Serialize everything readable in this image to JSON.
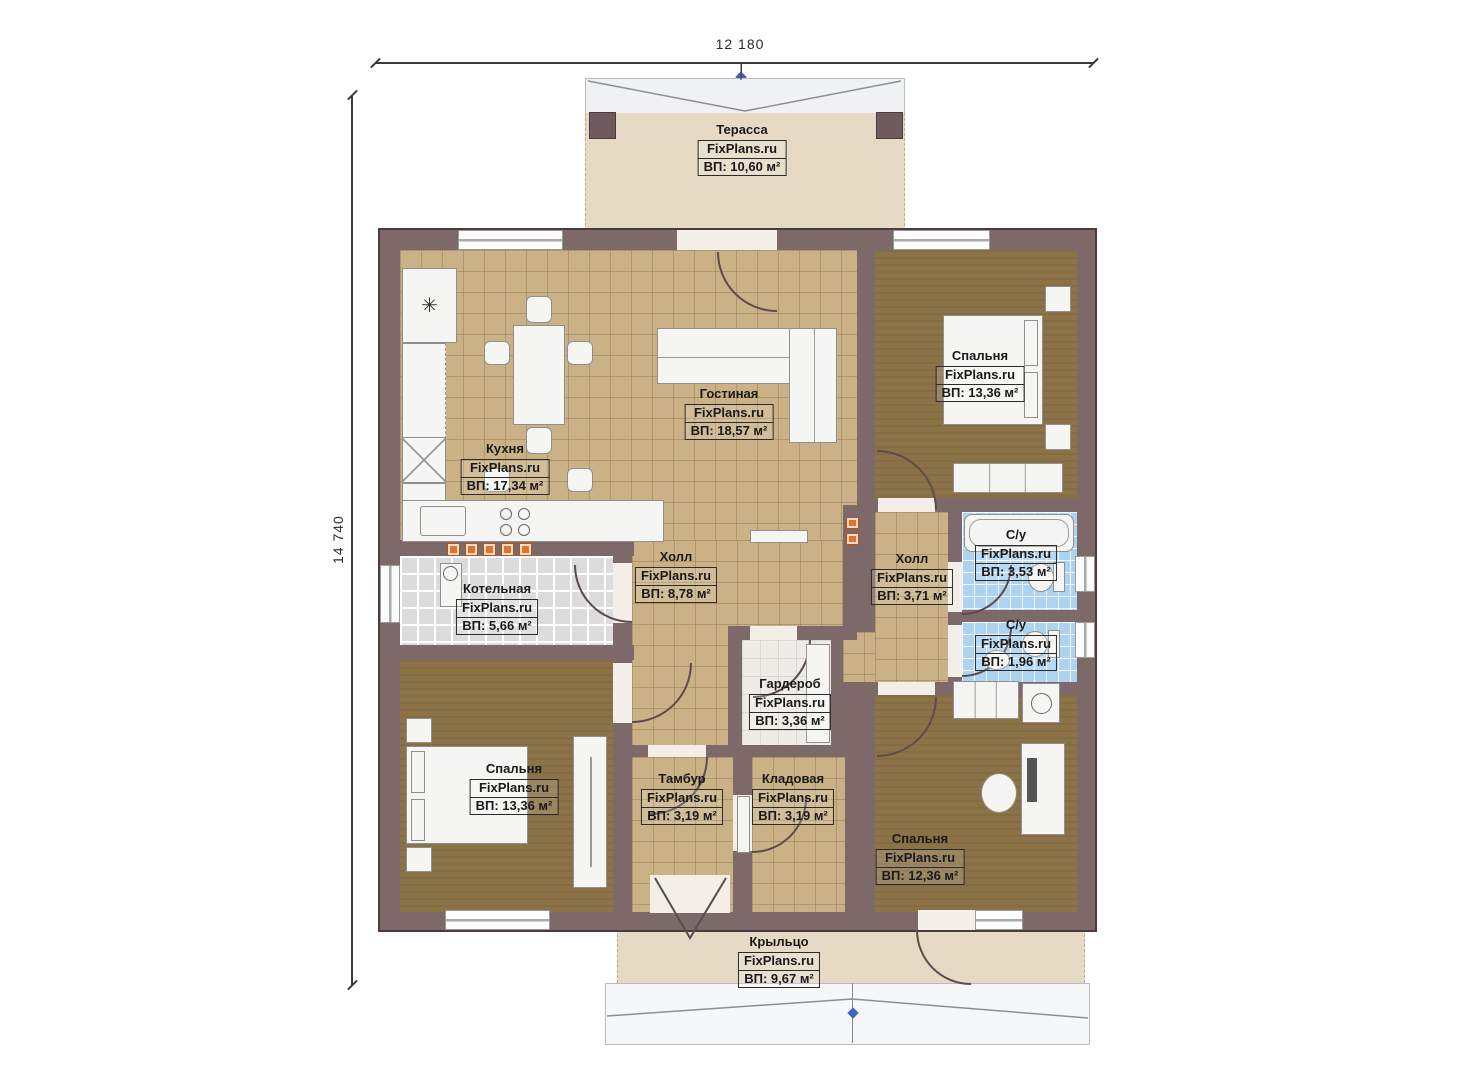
{
  "plan_title": "FixPlans.ru one-storey house floor plan",
  "dimensions": {
    "width_label": "12 180",
    "height_label": "14 740"
  },
  "rooms": [
    {
      "id": "terrace",
      "name": "Терасса",
      "watermark": "FixPlans.ru",
      "area": "ВП: 10,60 м²"
    },
    {
      "id": "kitchen",
      "name": "Кухня",
      "watermark": "FixPlans.ru",
      "area": "ВП: 17,34 м²"
    },
    {
      "id": "living",
      "name": "Гостиная",
      "watermark": "FixPlans.ru",
      "area": "ВП: 18,57 м²"
    },
    {
      "id": "bedroom-top",
      "name": "Спальня",
      "watermark": "FixPlans.ru",
      "area": "ВП: 13,36 м²"
    },
    {
      "id": "hall-main",
      "name": "Холл",
      "watermark": "FixPlans.ru",
      "area": "ВП: 8,78 м²"
    },
    {
      "id": "hall-small",
      "name": "Холл",
      "watermark": "FixPlans.ru",
      "area": "ВП: 3,71 м²"
    },
    {
      "id": "bath-large",
      "name": "С/у",
      "watermark": "FixPlans.ru",
      "area": "ВП: 3,53 м²"
    },
    {
      "id": "bath-small",
      "name": "С/у",
      "watermark": "FixPlans.ru",
      "area": "ВП: 1,96 м²"
    },
    {
      "id": "boiler",
      "name": "Котельная",
      "watermark": "FixPlans.ru",
      "area": "ВП: 5,66 м²"
    },
    {
      "id": "wardrobe",
      "name": "Гардероб",
      "watermark": "FixPlans.ru",
      "area": "ВП: 3,36 м²"
    },
    {
      "id": "bedroom-left",
      "name": "Спальня",
      "watermark": "FixPlans.ru",
      "area": "ВП: 13,36 м²"
    },
    {
      "id": "tambur",
      "name": "Тамбур",
      "watermark": "FixPlans.ru",
      "area": "ВП: 3,19 м²"
    },
    {
      "id": "pantry",
      "name": "Кладовая",
      "watermark": "FixPlans.ru",
      "area": "ВП: 3,19 м²"
    },
    {
      "id": "bedroom-right",
      "name": "Спальня",
      "watermark": "FixPlans.ru",
      "area": "ВП: 12,36 м²"
    },
    {
      "id": "porch",
      "name": "Крыльцо",
      "watermark": "FixPlans.ru",
      "area": "ВП: 9,67 м²"
    }
  ],
  "colors": {
    "wall": "#7d686a",
    "wall_outline": "#4a3c3e",
    "floor_tile_tan": "#cbb286",
    "floor_bedroom": "#8b7347",
    "floor_bath_blue": "#aed3f0",
    "floor_boiler_gray": "#dcdcdc",
    "terrace_beige": "#e6dac5",
    "roof_gray": "#eff1f3",
    "radiator_orange": "#e2712b",
    "grip_blue": "#3f62c4"
  }
}
